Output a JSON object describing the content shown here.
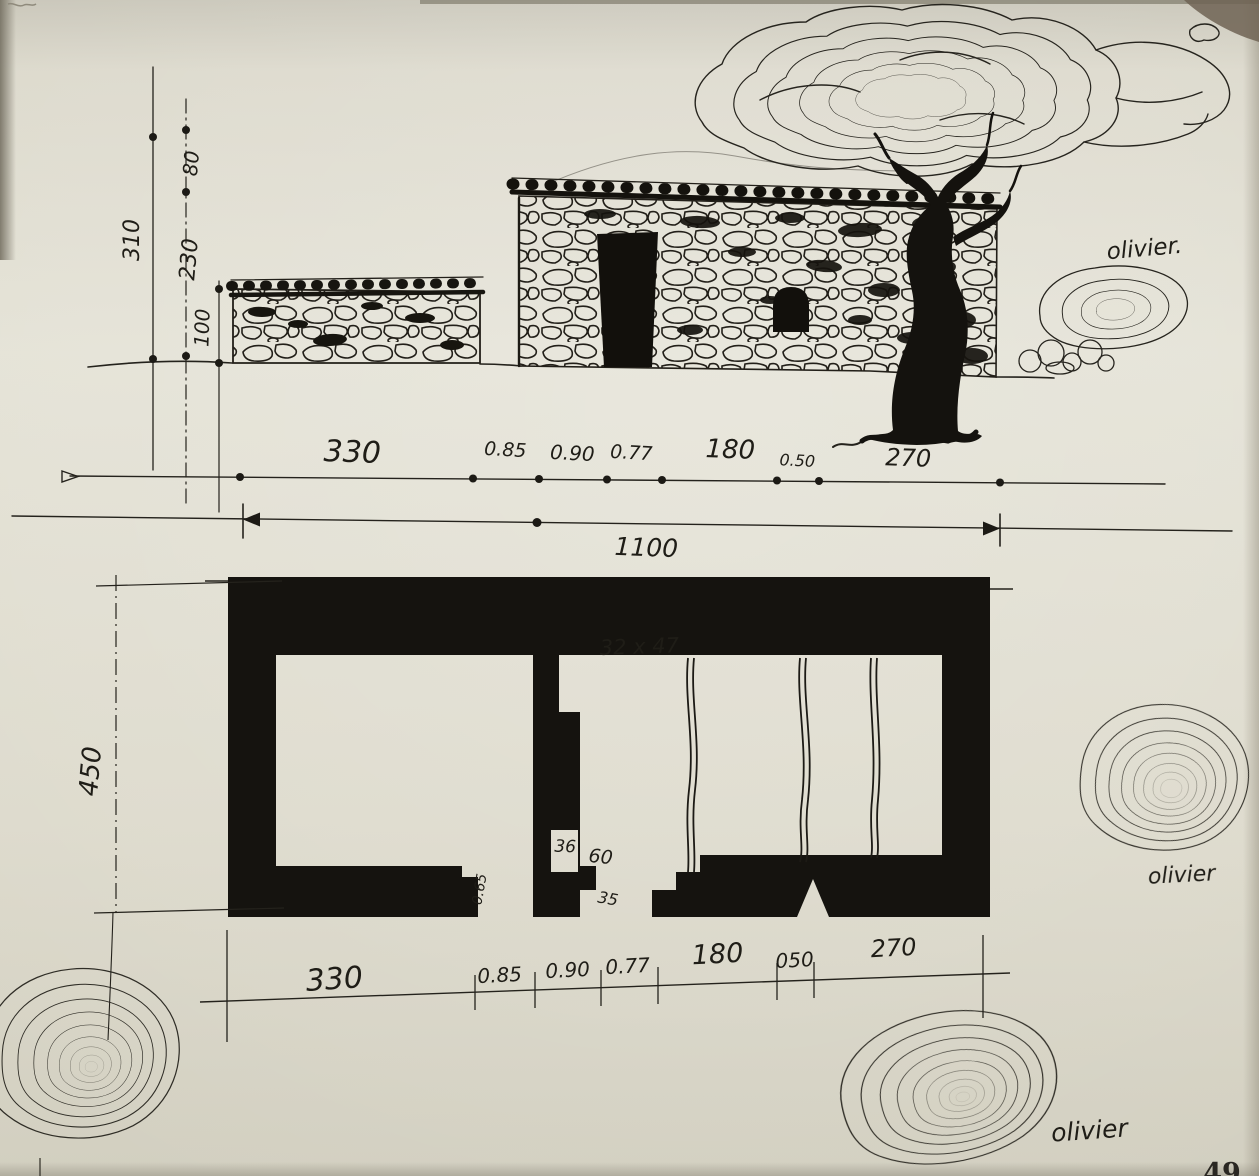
{
  "elevation": {
    "height_dims": [
      "310",
      "80",
      "230",
      "100"
    ],
    "width_dims": [
      "330",
      "0.85",
      "0.90",
      "0.77",
      "180",
      "0.50",
      "270"
    ],
    "total_width": "1100",
    "tree_label": "olivier."
  },
  "plan": {
    "height_dim": "450",
    "width_dims": [
      "330",
      "0.85",
      "0.90",
      "0.77",
      "180",
      "050",
      "270"
    ],
    "niche_label": "32 x 47",
    "jamb_width_label": "36",
    "jamb_depth_label": "60",
    "step_label": "35",
    "ledge_label": "0.65"
  },
  "plan_trees": {
    "right_label": "olivier",
    "bottom_label": "olivier"
  },
  "page": {
    "number": "49"
  }
}
